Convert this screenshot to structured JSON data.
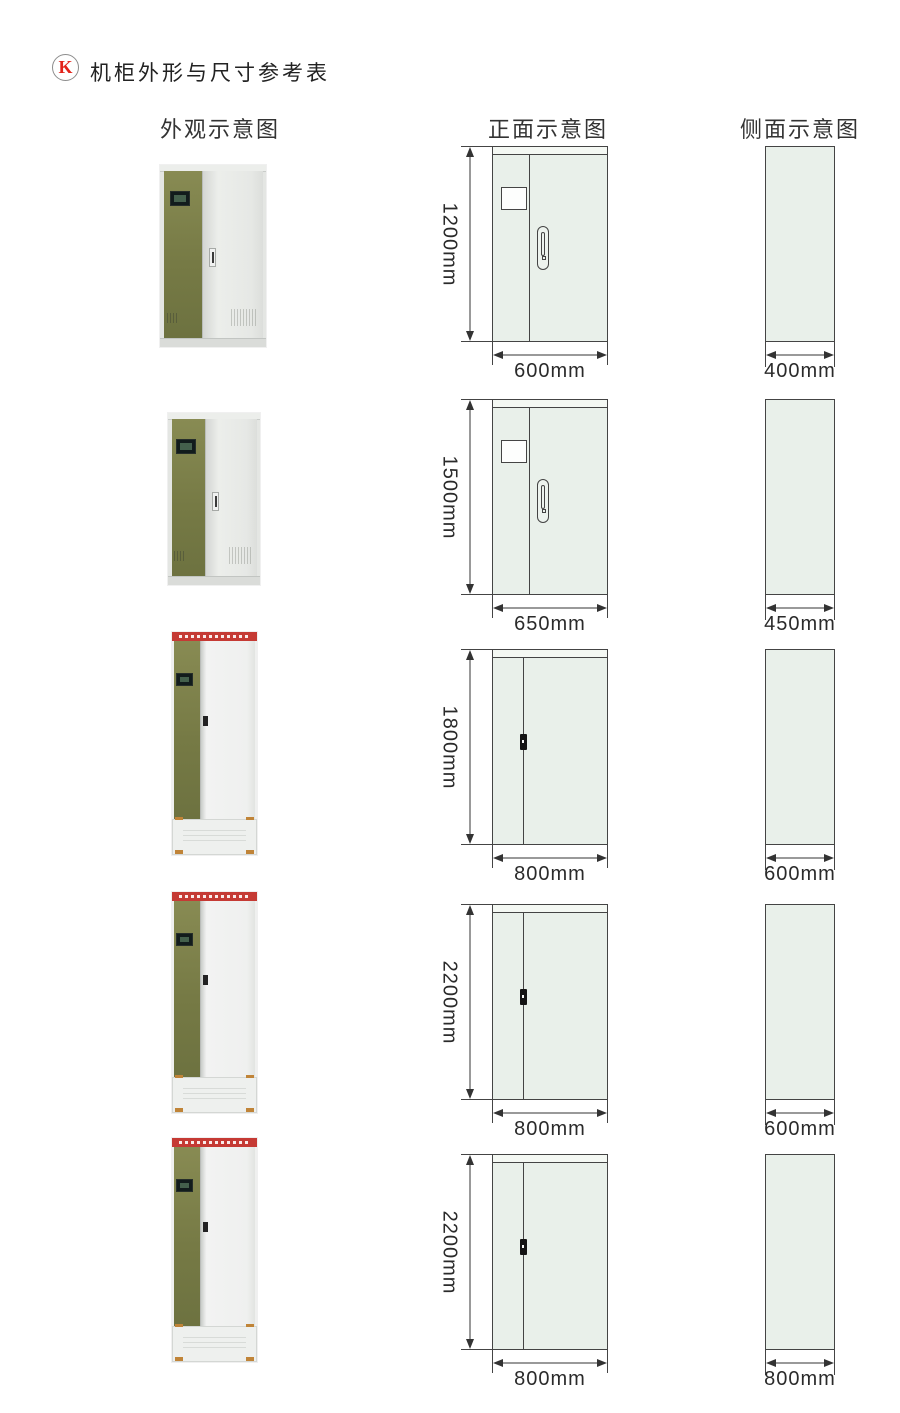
{
  "title": {
    "badge": "K",
    "text": "机柜外形与尺寸参考表"
  },
  "columns": {
    "appearance": "外观示意图",
    "front": "正面示意图",
    "side": "侧面示意图"
  },
  "rows": [
    {
      "height": "1200mm",
      "width": "600mm",
      "depth": "400mm"
    },
    {
      "height": "1500mm",
      "width": "650mm",
      "depth": "450mm"
    },
    {
      "height": "1800mm",
      "width": "800mm",
      "depth": "600mm"
    },
    {
      "height": "2200mm",
      "width": "800mm",
      "depth": "600mm"
    },
    {
      "height": "2200mm",
      "width": "800mm",
      "depth": "800mm"
    }
  ],
  "colors": {
    "badge_red": "#e2231a",
    "banner_red": "#c53a34",
    "drawing_fill": "#e9f0ea",
    "drawing_line": "#444444",
    "cabinet_olive": "#7b8048",
    "text": "#2a2a2a"
  }
}
